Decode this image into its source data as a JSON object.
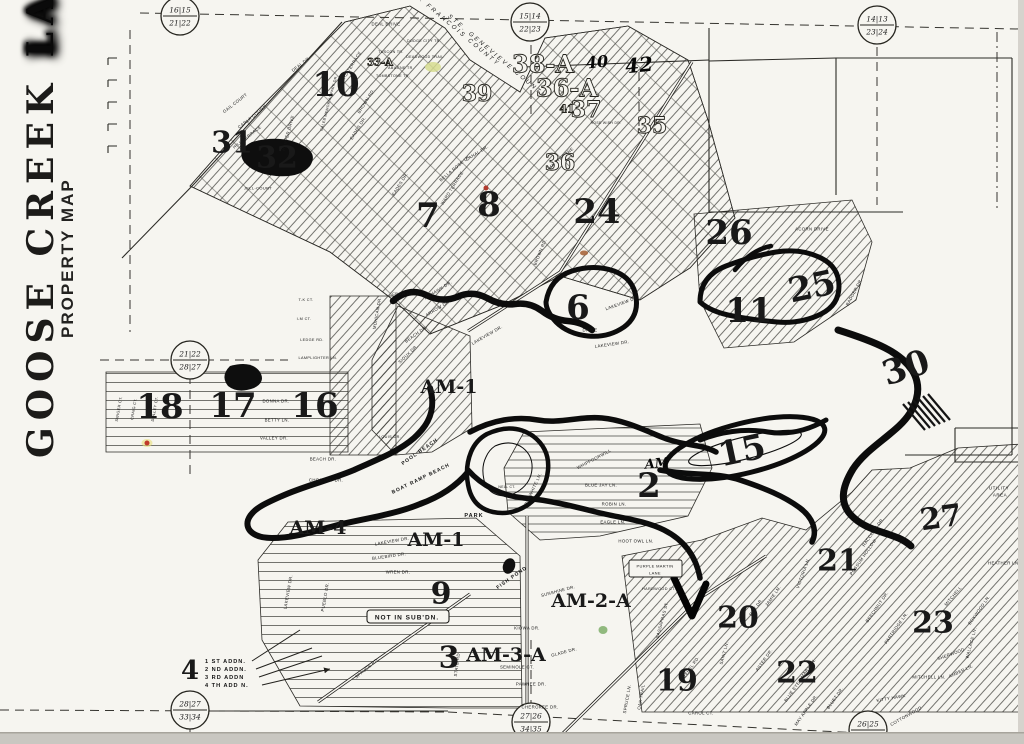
{
  "title": {
    "word1": "GOOSE",
    "word2": "CREEK",
    "word3": "LAKE",
    "subtitle": "PROPERTY MAP"
  },
  "colors": {
    "paper": "#f6f5f0",
    "ink": "#0c0c0c",
    "scan_edge": "#c9c7c1",
    "highlight": "#d6dc8f",
    "red_dot": "#b03a2e",
    "rust_mark": "#a8663c",
    "green_dot": "#7fae6a"
  },
  "map": {
    "corner_markers": [
      {
        "id": "nw",
        "x": 180,
        "y": 16,
        "top": "16|15",
        "bottom": "21|22"
      },
      {
        "id": "n",
        "x": 530,
        "y": 22,
        "top": "15|14",
        "bottom": "22|23"
      },
      {
        "id": "ne",
        "x": 877,
        "y": 25,
        "top": "14|13",
        "bottom": "23|24"
      },
      {
        "id": "w",
        "x": 190,
        "y": 360,
        "top": "21|22",
        "bottom": "28|27"
      },
      {
        "id": "sw",
        "x": 190,
        "y": 710,
        "top": "28|27",
        "bottom": "33|34"
      },
      {
        "id": "s",
        "x": 531,
        "y": 722,
        "top": "27|26",
        "bottom": "34|35"
      },
      {
        "id": "se",
        "x": 868,
        "y": 730,
        "top": "26|25",
        "bottom": "35|36"
      }
    ],
    "sections": [
      {
        "t": "10",
        "x": 336,
        "y": 85
      },
      {
        "t": "31",
        "x": 232,
        "y": 143,
        "fs": 30
      },
      {
        "t": "32",
        "x": 277,
        "y": 158,
        "fs": 30
      },
      {
        "t": "7",
        "x": 428,
        "y": 216
      },
      {
        "t": "8",
        "x": 489,
        "y": 205
      },
      {
        "t": "24",
        "x": 597,
        "y": 212
      },
      {
        "t": "26",
        "x": 729,
        "y": 233
      },
      {
        "t": "6",
        "x": 578,
        "y": 308
      },
      {
        "t": "11",
        "x": 749,
        "y": 311
      },
      {
        "t": "25",
        "x": 812,
        "y": 287,
        "r": -12
      },
      {
        "t": "30",
        "x": 906,
        "y": 368,
        "r": -18
      },
      {
        "t": "18",
        "x": 160,
        "y": 407
      },
      {
        "t": "17",
        "x": 233,
        "y": 406
      },
      {
        "t": "16",
        "x": 315,
        "y": 406
      },
      {
        "t": "2",
        "x": 649,
        "y": 486
      },
      {
        "t": "15",
        "x": 742,
        "y": 451,
        "r": -12
      },
      {
        "t": "27",
        "x": 941,
        "y": 518,
        "fs": 30,
        "r": -8
      },
      {
        "t": "21",
        "x": 838,
        "y": 561,
        "fs": 30
      },
      {
        "t": "20",
        "x": 738,
        "y": 618,
        "fs": 30
      },
      {
        "t": "22",
        "x": 797,
        "y": 673,
        "fs": 30
      },
      {
        "t": "23",
        "x": 933,
        "y": 623,
        "fs": 30
      },
      {
        "t": "19",
        "x": 677,
        "y": 681,
        "fs": 30
      },
      {
        "t": "9",
        "x": 441,
        "y": 594,
        "fs": 30
      },
      {
        "t": "3",
        "x": 449,
        "y": 658,
        "fs": 30
      },
      {
        "t": "4",
        "x": 190,
        "y": 671,
        "fs": 26
      },
      {
        "t": "AM-1",
        "x": 449,
        "y": 387,
        "fs": 19
      },
      {
        "t": "AM-1",
        "x": 436,
        "y": 540,
        "fs": 19
      },
      {
        "t": "AM-4",
        "x": 318,
        "y": 528,
        "fs": 19
      },
      {
        "t": "AM-2-A",
        "x": 591,
        "y": 601,
        "fs": 19
      },
      {
        "t": "AM-3-A",
        "x": 506,
        "y": 655,
        "fs": 19
      },
      {
        "t": "38-A",
        "x": 543,
        "y": 64,
        "fs": 24,
        "cls": "outline"
      },
      {
        "t": "36-A",
        "x": 567,
        "y": 88,
        "fs": 24,
        "cls": "outline"
      },
      {
        "t": "36",
        "x": 560,
        "y": 163,
        "fs": 22,
        "cls": "outline"
      },
      {
        "t": "39",
        "x": 477,
        "y": 94,
        "fs": 22,
        "cls": "outline"
      },
      {
        "t": "41",
        "x": 567,
        "y": 109,
        "fs": 11,
        "cls": "outline"
      },
      {
        "t": "37",
        "x": 586,
        "y": 110,
        "fs": 22,
        "cls": "outline"
      },
      {
        "t": "35",
        "x": 652,
        "y": 126,
        "fs": 22,
        "cls": "outline"
      },
      {
        "t": "33-A",
        "x": 380,
        "y": 63,
        "fs": 10,
        "cls": "outline"
      }
    ],
    "street_labels": [
      {
        "t": "GAIL COURT",
        "x": 235,
        "y": 103,
        "r": -38
      },
      {
        "t": "CARLA COURT",
        "x": 252,
        "y": 117,
        "r": -38
      },
      {
        "t": "HILL TERRACE",
        "x": 247,
        "y": 137,
        "r": -38
      },
      {
        "t": "HARPER DRIVE",
        "x": 288,
        "y": 133,
        "r": -75
      },
      {
        "t": "CALEB MEMORIAL PARK DR.",
        "x": 329,
        "y": 103,
        "r": -75,
        "fs": 3.6
      },
      {
        "t": "JELL-COURT",
        "x": 258,
        "y": 188,
        "fs": 4
      },
      {
        "t": "DEAL DR.",
        "x": 301,
        "y": 64,
        "r": -38
      },
      {
        "t": "DEAL DRIVE",
        "x": 386,
        "y": 24
      },
      {
        "t": "DODGE CITY TR.",
        "x": 424,
        "y": 41,
        "fs": 3.6
      },
      {
        "t": "TUSCON TR.",
        "x": 391,
        "y": 52,
        "fs": 3.6
      },
      {
        "t": "DEADWOOD TRAIL",
        "x": 425,
        "y": 57,
        "fs": 3.6
      },
      {
        "t": "ABILENE TR.",
        "x": 401,
        "y": 68,
        "fs": 3.6
      },
      {
        "t": "TOMBSTONE TR.",
        "x": 393,
        "y": 76,
        "fs": 3.6
      },
      {
        "t": "WARD TERRACE",
        "x": 350,
        "y": 68,
        "r": -58
      },
      {
        "t": "BROWN RD.",
        "x": 366,
        "y": 101,
        "r": -58
      },
      {
        "t": "EADES DR.",
        "x": 358,
        "y": 128,
        "r": -58
      },
      {
        "t": "WARD TERRACE",
        "x": 452,
        "y": 188,
        "r": -58
      },
      {
        "t": "EADES DR.",
        "x": 400,
        "y": 184,
        "r": -58
      },
      {
        "t": "BROWN RD.",
        "x": 540,
        "y": 252,
        "r": -68
      },
      {
        "t": "BELLA ROSE LN.",
        "x": 455,
        "y": 168,
        "r": -40
      },
      {
        "t": "CANAL DR.",
        "x": 477,
        "y": 153,
        "r": -32
      },
      {
        "t": "HAWTHORNE",
        "x": 561,
        "y": 158,
        "r": -40
      },
      {
        "t": "ROSE WISH DR.",
        "x": 606,
        "y": 123,
        "fs": 3.4
      },
      {
        "t": "ACORN DRIVE",
        "x": 812,
        "y": 229
      },
      {
        "t": "BADGER DR.",
        "x": 854,
        "y": 292,
        "r": -62
      },
      {
        "t": "T-K CT.",
        "x": 306,
        "y": 300,
        "fs": 3.8
      },
      {
        "t": "I-M CT.",
        "x": 304,
        "y": 319,
        "fs": 3.8
      },
      {
        "t": "LEDGE RD.",
        "x": 312,
        "y": 340,
        "fs": 3.8
      },
      {
        "t": "LAMPLIGHTER LN.",
        "x": 318,
        "y": 358,
        "fs": 3.8
      },
      {
        "t": "MOHICAN DR.",
        "x": 377,
        "y": 313,
        "r": -80
      },
      {
        "t": "CROW LN.",
        "x": 403,
        "y": 294,
        "fs": 3.8
      },
      {
        "t": "MOHAWK DR.",
        "x": 438,
        "y": 290,
        "r": -32
      },
      {
        "t": "ARROW DR.",
        "x": 438,
        "y": 308,
        "r": -32
      },
      {
        "t": "BEACH DR.",
        "x": 416,
        "y": 334,
        "r": -36
      },
      {
        "t": "SIOUX DR.",
        "x": 408,
        "y": 354,
        "r": -44
      },
      {
        "t": "LAKEVIEW DR.",
        "x": 487,
        "y": 335,
        "r": -30
      },
      {
        "t": "DRIVE",
        "x": 590,
        "y": 330
      },
      {
        "t": "LAKEVIEW DR.",
        "x": 612,
        "y": 344,
        "r": -8
      },
      {
        "t": "LAKEVIEW DR.",
        "x": 622,
        "y": 303,
        "r": -20
      },
      {
        "t": "SWIGER CT.",
        "x": 119,
        "y": 409,
        "r": -80,
        "fs": 3.8
      },
      {
        "t": "CRAIG CT.",
        "x": 134,
        "y": 409,
        "r": -80,
        "fs": 3.8
      },
      {
        "t": "DOLLEY CT.",
        "x": 155,
        "y": 409,
        "r": -80,
        "fs": 3.8
      },
      {
        "t": "DONNA DR.",
        "x": 276,
        "y": 401
      },
      {
        "t": "BETTY LN.",
        "x": 277,
        "y": 420
      },
      {
        "t": "VALLEY DR.",
        "x": 274,
        "y": 438
      },
      {
        "t": "BEACH DR.",
        "x": 323,
        "y": 459
      },
      {
        "t": "CHOCTAW DR.",
        "x": 326,
        "y": 480
      },
      {
        "t": "LOUIS DR.",
        "x": 390,
        "y": 437,
        "fs": 3.8
      },
      {
        "t": "LAKEVIEW DR.",
        "x": 392,
        "y": 541,
        "r": -10
      },
      {
        "t": "BLUEBIRD DR.",
        "x": 389,
        "y": 556,
        "r": -8
      },
      {
        "t": "WREN DR.",
        "x": 398,
        "y": 572
      },
      {
        "t": "LAKEVIEW DR.",
        "x": 288,
        "y": 592,
        "r": -80
      },
      {
        "t": "PUEBLO DR.",
        "x": 325,
        "y": 597,
        "r": -80
      },
      {
        "t": "SPRUCE RD.",
        "x": 367,
        "y": 668,
        "r": -40
      },
      {
        "t": "STATE RD.",
        "x": 457,
        "y": 664,
        "r": -82
      },
      {
        "t": "KIOWA DR.",
        "x": 527,
        "y": 628
      },
      {
        "t": "SEMINOLE CT.",
        "x": 517,
        "y": 667
      },
      {
        "t": "PAWNEE DR.",
        "x": 531,
        "y": 684
      },
      {
        "t": "CHEROKEE DR.",
        "x": 540,
        "y": 707
      },
      {
        "t": "GLADE DR.",
        "x": 564,
        "y": 652,
        "r": -15
      },
      {
        "t": "SUNSHINE DR.",
        "x": 558,
        "y": 591,
        "r": -15
      },
      {
        "t": "WHIPPOORWILL",
        "x": 594,
        "y": 459,
        "r": -28
      },
      {
        "t": "BLUE JAY LN.",
        "x": 601,
        "y": 485
      },
      {
        "t": "ROBIN LN.",
        "x": 614,
        "y": 504
      },
      {
        "t": "EAGLE LN.",
        "x": 613,
        "y": 522
      },
      {
        "t": "HOOT OWL LN.",
        "x": 636,
        "y": 541
      },
      {
        "t": "BOBWHITE LN.",
        "x": 533,
        "y": 489,
        "r": -65
      },
      {
        "t": "NELL CT.",
        "x": 507,
        "y": 487,
        "fs": 3.4
      },
      {
        "t": "HARDWOOD CT.",
        "x": 659,
        "y": 589,
        "fs": 3.8
      },
      {
        "t": "SASSAFRAS ST.",
        "x": 662,
        "y": 620,
        "r": -75
      },
      {
        "t": "REBEL RD.",
        "x": 691,
        "y": 667,
        "r": -55
      },
      {
        "t": "SAINT LN.",
        "x": 724,
        "y": 653,
        "r": -75
      },
      {
        "t": "OAK TRAIL",
        "x": 641,
        "y": 697,
        "r": -80
      },
      {
        "t": "SPRUCE LN.",
        "x": 627,
        "y": 699,
        "r": -80
      },
      {
        "t": "CAROL CT.",
        "x": 701,
        "y": 713
      },
      {
        "t": "JAMIE LN.",
        "x": 773,
        "y": 596,
        "r": -55
      },
      {
        "t": "ROY DR.",
        "x": 756,
        "y": 607,
        "r": -55
      },
      {
        "t": "ASTER DR.",
        "x": 764,
        "y": 660,
        "r": -55
      },
      {
        "t": "BLUE EYED MARY LN.",
        "x": 800,
        "y": 680,
        "r": -55
      },
      {
        "t": "MAY APPLE DR.",
        "x": 806,
        "y": 710,
        "r": -55
      },
      {
        "t": "BLUET DR.",
        "x": 835,
        "y": 698,
        "r": -55
      },
      {
        "t": "RACCOON DR.",
        "x": 873,
        "y": 532,
        "r": -55
      },
      {
        "t": "POSSUM HOLLOW",
        "x": 863,
        "y": 557,
        "r": -55
      },
      {
        "t": "VICTORIA LN.",
        "x": 803,
        "y": 573,
        "r": -70
      },
      {
        "t": "PARTRIDGE LN.",
        "x": 896,
        "y": 628,
        "r": -55
      },
      {
        "t": "BEECHNUT DR.",
        "x": 877,
        "y": 607,
        "r": -55
      },
      {
        "t": "MITCHELL",
        "x": 953,
        "y": 596,
        "r": -50
      },
      {
        "t": "BOXWOOD LN.",
        "x": 979,
        "y": 610,
        "r": -55
      },
      {
        "t": "SHERWOOD",
        "x": 951,
        "y": 654,
        "r": -20
      },
      {
        "t": "AMBER LN.",
        "x": 961,
        "y": 671,
        "r": -25
      },
      {
        "t": "MITCHELL LN.",
        "x": 929,
        "y": 677
      },
      {
        "t": "WALLACE LN.",
        "x": 971,
        "y": 643,
        "r": -75
      },
      {
        "t": "KITTY HAWK",
        "x": 891,
        "y": 698,
        "r": -10
      },
      {
        "t": "COTTONWOOD",
        "x": 906,
        "y": 716,
        "r": -30
      },
      {
        "t": "HEATHER LN.",
        "x": 1004,
        "y": 563
      },
      {
        "t": "PURPLE MARTIN",
        "x": 655,
        "y": 566,
        "fs": 4
      },
      {
        "t": "LANE",
        "x": 655,
        "y": 573,
        "fs": 4
      }
    ],
    "labels": [
      {
        "t": "STE. GENEVIEVE COUNTY",
        "x": 497,
        "y": 57,
        "r": 40,
        "fs": 6,
        "cls": "county"
      },
      {
        "t": "ST. FRANCOIS COUNTY",
        "x": 455,
        "y": 29,
        "r": 40,
        "fs": 6,
        "cls": "county"
      },
      {
        "t": "NOT IN SUB'DN.",
        "x": 407,
        "y": 618,
        "fs": 6.5,
        "cls": "strong"
      },
      {
        "t": "UTILITY",
        "x": 999,
        "y": 488,
        "fs": 4.5
      },
      {
        "t": "AREA",
        "x": 1000,
        "y": 495,
        "fs": 4.5
      },
      {
        "t": "PARK",
        "x": 474,
        "y": 516,
        "fs": 5.5,
        "cls": "strong"
      },
      {
        "t": "FISH POND",
        "x": 512,
        "y": 578,
        "r": -35,
        "fs": 5,
        "cls": "strong"
      },
      {
        "t": "POOL BEACH",
        "x": 420,
        "y": 452,
        "r": -35,
        "fs": 5,
        "cls": "strong"
      },
      {
        "t": "BOAT RAMP BEACH",
        "x": 421,
        "y": 479,
        "r": -26,
        "fs": 5,
        "cls": "strong"
      }
    ],
    "annotations": [
      {
        "t": "40",
        "x": 597,
        "y": 62,
        "fs": 16
      },
      {
        "t": "42",
        "x": 639,
        "y": 65,
        "fs": 20
      },
      {
        "t": "AM",
        "x": 657,
        "y": 464,
        "fs": 13
      }
    ],
    "legend": {
      "number": "4",
      "items": [
        "1 ST ADDN.",
        "2 ND ADDN.",
        "3 RD ADDN",
        "4 TH ADD N."
      ]
    },
    "marks": [
      {
        "name": "yellow-highlight",
        "x": 433,
        "y": 67,
        "rx": 8,
        "ry": 5,
        "c": "#d6dc8f",
        "o": 0.85
      },
      {
        "name": "red-dot",
        "x": 486,
        "y": 188,
        "rx": 2.5,
        "ry": 2.5,
        "c": "#b03a2e",
        "o": 1
      },
      {
        "name": "rust-mark",
        "x": 584,
        "y": 253,
        "rx": 4,
        "ry": 2.5,
        "c": "#a8663c",
        "o": 0.9
      },
      {
        "name": "yellow-halo",
        "x": 147,
        "y": 443,
        "rx": 5.5,
        "ry": 4,
        "c": "#e8e07a",
        "o": 0.6
      },
      {
        "name": "red-dot",
        "x": 147,
        "y": 443,
        "rx": 2.5,
        "ry": 2.5,
        "c": "#c0392b",
        "o": 1
      },
      {
        "name": "green-dot",
        "x": 603,
        "y": 630,
        "rx": 4.5,
        "ry": 4,
        "c": "#7fae6a",
        "o": 0.85
      }
    ]
  }
}
